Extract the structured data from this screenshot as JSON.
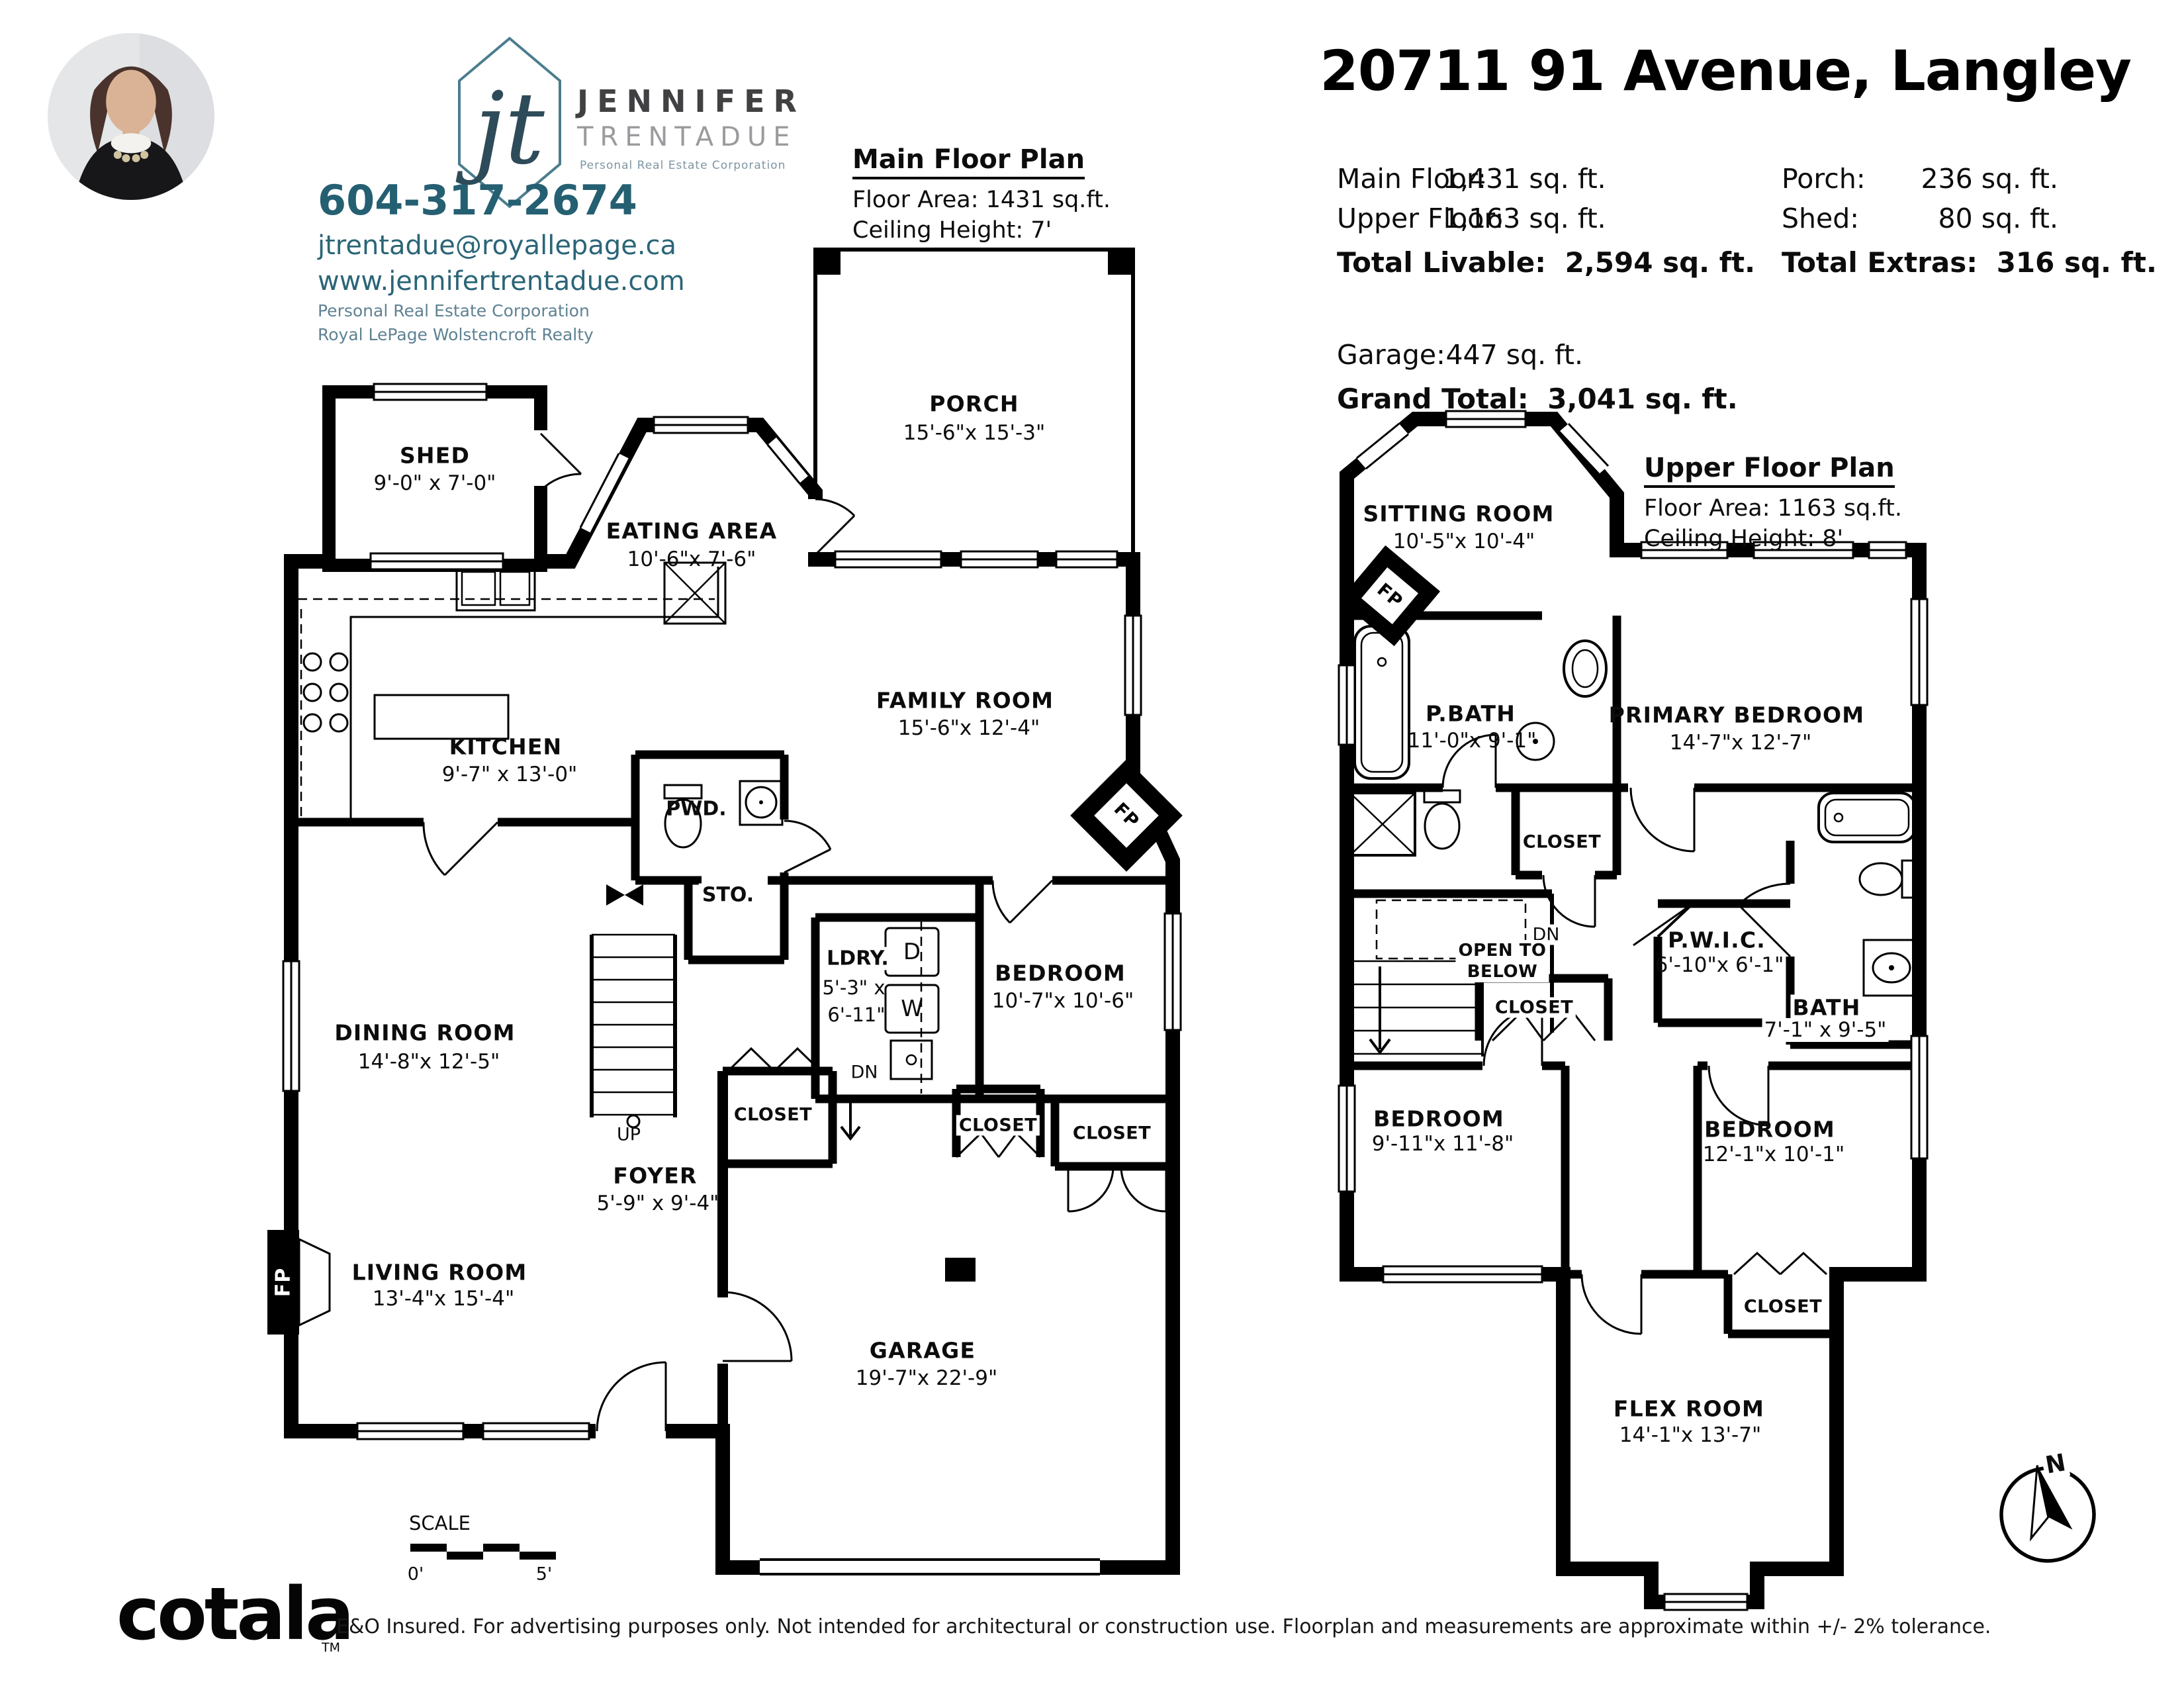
{
  "agent": {
    "monogram": "jt",
    "first_name": "JENNIFER",
    "last_name": "TRENTADUE",
    "designation": "Personal Real Estate Corporation",
    "phone": "604-317-2674",
    "email": "jtrentadue@royallepage.ca",
    "website": "www.jennifertrentadue.com",
    "corp_line": "Personal Real Estate Corporation",
    "brokerage": "Royal LePage Wolstencroft Realty"
  },
  "title": "20711 91 Avenue, Langley",
  "stats": {
    "main_floor_label": "Main Floor:",
    "main_floor_value": "1,431 sq. ft.",
    "upper_floor_label": "Upper Floor:",
    "upper_floor_value": "1,163 sq. ft.",
    "total_livable_label": "Total Livable:",
    "total_livable_value": "2,594 sq. ft.",
    "porch_label": "Porch:",
    "porch_value": "236 sq. ft.",
    "shed_label": "Shed:",
    "shed_value": "80 sq. ft.",
    "total_extras_label": "Total Extras:",
    "total_extras_value": "316 sq. ft.",
    "garage_label": "Garage:",
    "garage_value": "447 sq. ft.",
    "grand_total_label": "Grand Total:",
    "grand_total_value": "3,041 sq. ft."
  },
  "main_plan": {
    "heading": "Main Floor Plan",
    "floor_area": "Floor Area: 1431 sq.ft.",
    "ceiling": "Ceiling Height: 7'",
    "rooms": {
      "porch": {
        "name": "PORCH",
        "dims": "15'-6\"x 15'-3\""
      },
      "shed": {
        "name": "SHED",
        "dims": "9'-0\" x 7'-0\""
      },
      "eating": {
        "name": "EATING AREA",
        "dims": "10'-6\"x 7'-6\""
      },
      "family": {
        "name": "FAMILY ROOM",
        "dims": "15'-6\"x 12'-4\""
      },
      "kitchen": {
        "name": "KITCHEN",
        "dims": "9'-7\" x 13'-0\""
      },
      "pwd": {
        "name": "PWD."
      },
      "sto": {
        "name": "STO."
      },
      "dining": {
        "name": "DINING ROOM",
        "dims": "14'-8\"x 12'-5\""
      },
      "ldry": {
        "name": "LDRY.",
        "dims1": "5'-3\" x",
        "dims2": "6'-11\""
      },
      "bedroom": {
        "name": "BEDROOM",
        "dims": "10'-7\"x 10'-6\""
      },
      "foyer": {
        "name": "FOYER",
        "dims": "5'-9\" x 9'-4\""
      },
      "living": {
        "name": "LIVING ROOM",
        "dims": "13'-4\"x 15'-4\""
      },
      "garage": {
        "name": "GARAGE",
        "dims": "19'-7\"x 22'-9\""
      },
      "closet1": "CLOSET",
      "closet2": "CLOSET",
      "closet3": "CLOSET",
      "up": "UP",
      "dn": "DN",
      "dryer": "D",
      "washer": "W",
      "fp1": "FP",
      "fp2": "FP"
    },
    "scale": {
      "label": "SCALE",
      "start": "0'",
      "end": "5'"
    }
  },
  "upper_plan": {
    "heading": "Upper Floor Plan",
    "floor_area": "Floor Area: 1163 sq.ft.",
    "ceiling": "Ceiling Height: 8'",
    "rooms": {
      "sitting": {
        "name": "SITTING ROOM",
        "dims": "10'-5\"x 10'-4\""
      },
      "pbath": {
        "name": "P.BATH",
        "dims": "11'-0\"x 9'-1\""
      },
      "primary": {
        "name": "PRIMARY BEDROOM",
        "dims": "14'-7\"x 12'-7\""
      },
      "pwic": {
        "name": "P.W.I.C.",
        "dims": "6'-10\"x 6'-1\""
      },
      "bath": {
        "name": "BATH",
        "dims": "7'-1\" x 9'-5\""
      },
      "bedroom_left": {
        "name": "BEDROOM",
        "dims": "9'-11\"x 11'-8\""
      },
      "bedroom_right": {
        "name": "BEDROOM",
        "dims": "12'-1\"x 10'-1\""
      },
      "flex": {
        "name": "FLEX ROOM",
        "dims": "14'-1\"x 13'-7\""
      },
      "open_below_1": "OPEN TO",
      "open_below_2": "BELOW",
      "closet_top": "CLOSET",
      "closet_mid": "CLOSET",
      "closet_bottom": "CLOSET",
      "dn": "DN",
      "fp": "FP"
    },
    "compass_n": "N"
  },
  "footer": {
    "brand": "cotala",
    "tm": "TM",
    "disclaimer": "E&O Insured. For advertising purposes only. Not intended for architectural or construction use. Floorplan and measurements are approximate within +/- 2% tolerance."
  }
}
